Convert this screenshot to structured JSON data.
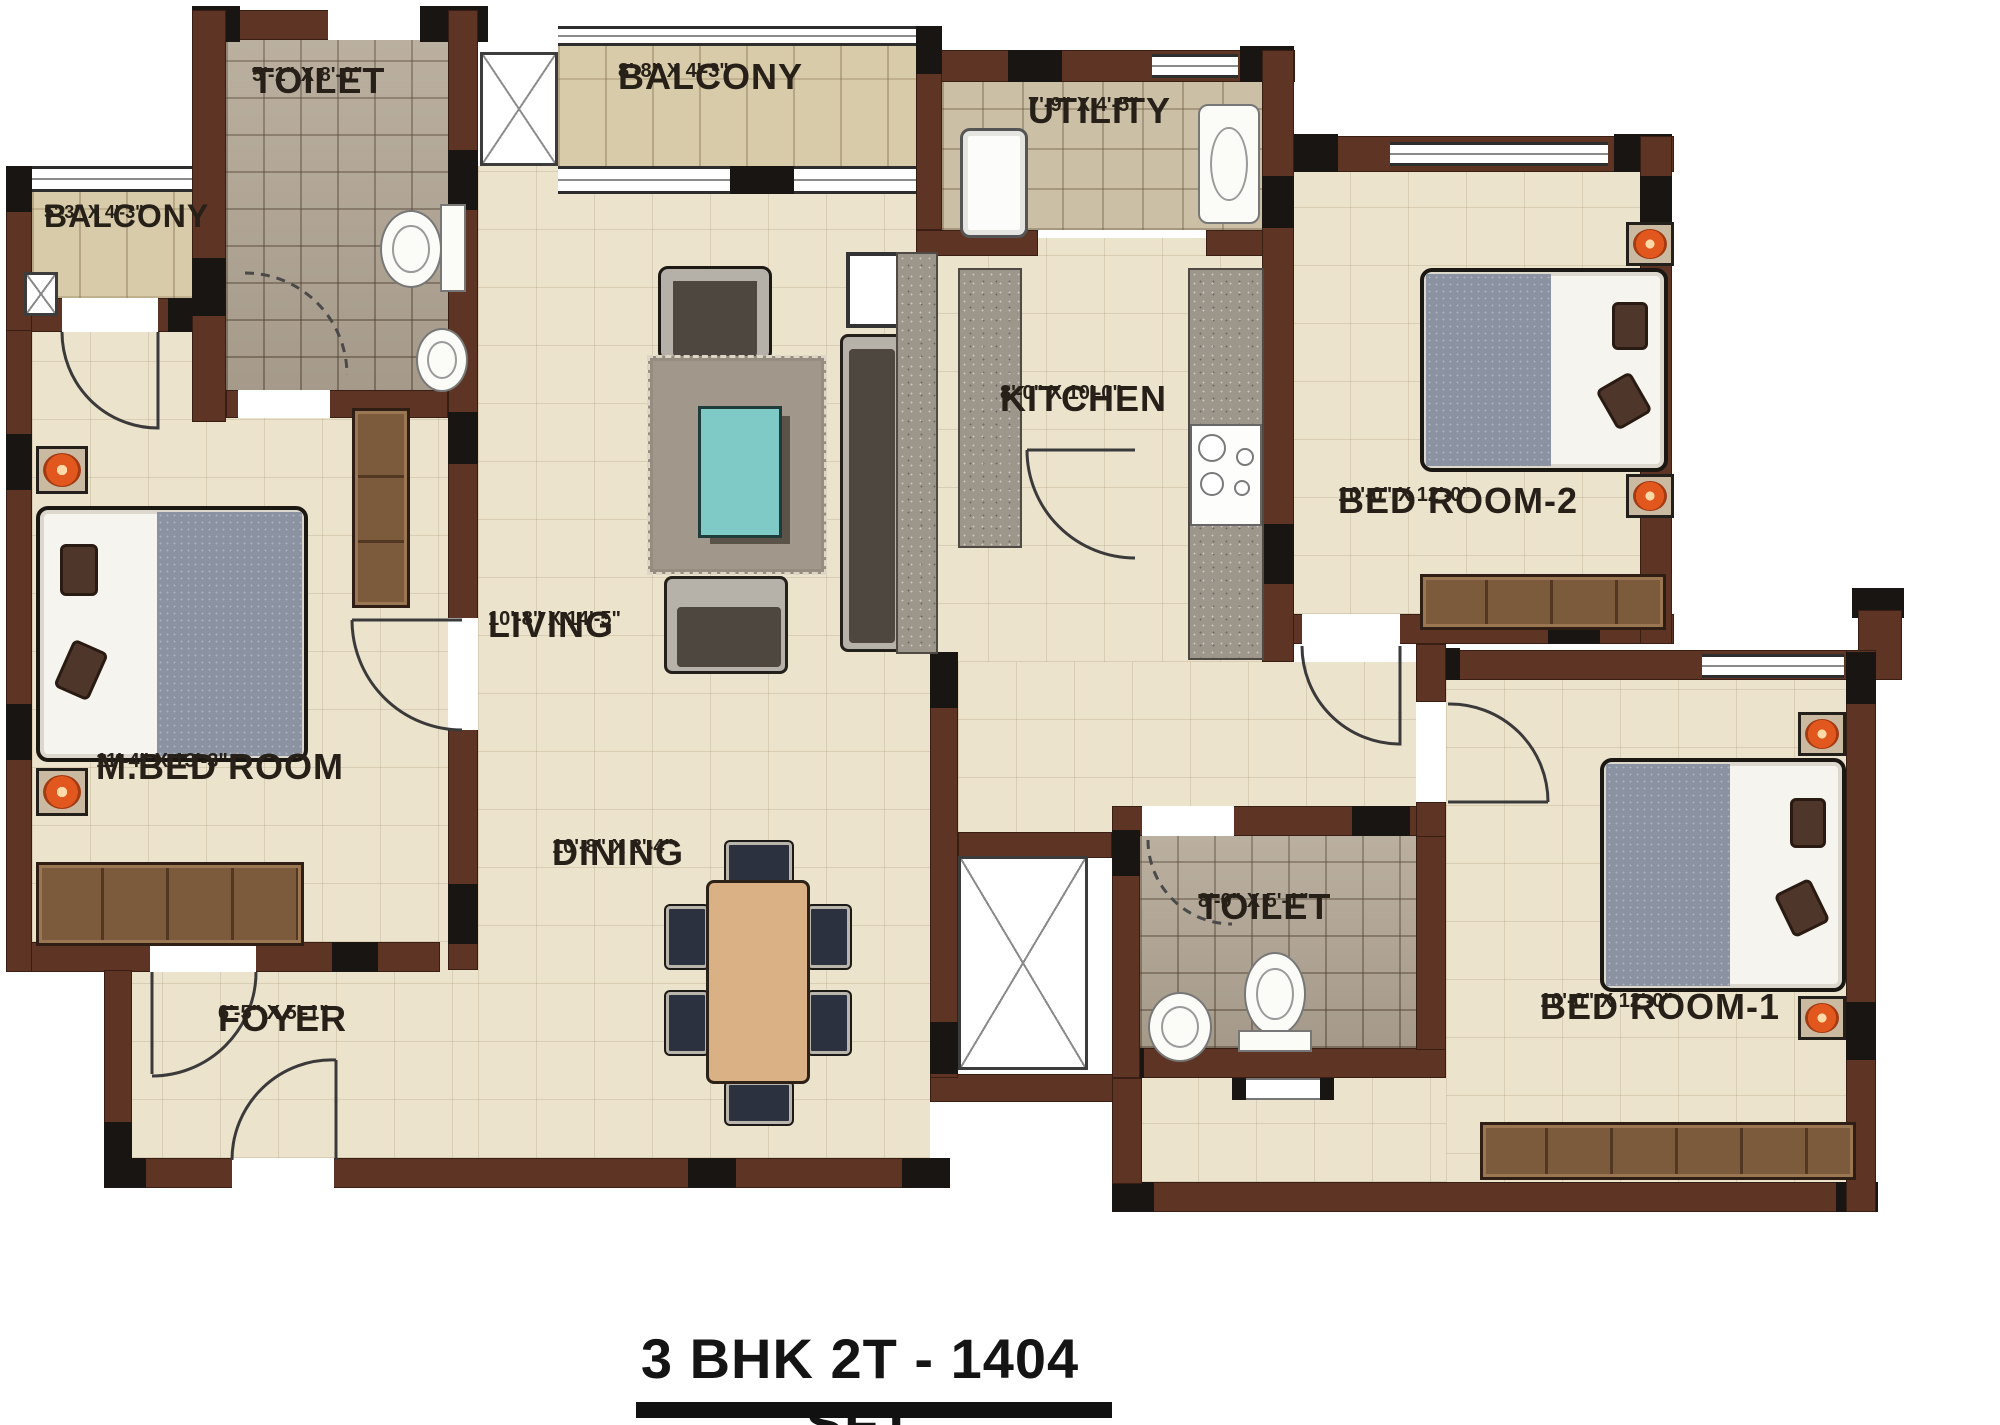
{
  "title": {
    "text": "3 BHK 2T - 1404 SFT"
  },
  "rooms": [
    {
      "name": "TOILET",
      "dims": "5'-1\" X 8'-0\""
    },
    {
      "name": "BALCONY",
      "dims": "8'-8\" X 4'-3\""
    },
    {
      "name": "UTILITY",
      "dims": "7'-9\" X 4'-5\""
    },
    {
      "name": "BALCONY",
      "dims": "5'-3\" X 4'-3\""
    },
    {
      "name": "KITCHEN",
      "dims": "8'-0\" X 10'-0\""
    },
    {
      "name": "BED ROOM-2",
      "dims": "10'-0\" X 12'-0\""
    },
    {
      "name": "M.BED ROOM",
      "dims": "11'-4\" X 13'-3\""
    },
    {
      "name": "LIVING",
      "dims": "10'-8\" X 14'-5\""
    },
    {
      "name": "DINING",
      "dims": "10'-8\" X 8'-4\""
    },
    {
      "name": "FOYER",
      "dims": "6'-5\" X 5'-1\""
    },
    {
      "name": "TOILET",
      "dims": "8'-0\" X 5'-1\""
    },
    {
      "name": "BED ROOM-1",
      "dims": "10'-0\" X 12'-0\""
    }
  ],
  "colors": {
    "wall": "#5e3424",
    "wall_dark": "#181512",
    "floor": "#ece3cd",
    "tile": "#b3a795",
    "balcony_tile": "#d8cba9",
    "utility_tile": "#cbc0a6",
    "counter": "#9d978b",
    "teal": "#7fc9c6",
    "blanket": "#8b93a3",
    "pillow": "#4e362a",
    "lamp": "#e2571e",
    "wood": "#7c5a3c",
    "table_wood": "#d9b184",
    "chair": "#2c3140",
    "sofa_light": "#b6b2a9",
    "sofa_dark": "#4d473f",
    "rug": "#a1978a"
  }
}
